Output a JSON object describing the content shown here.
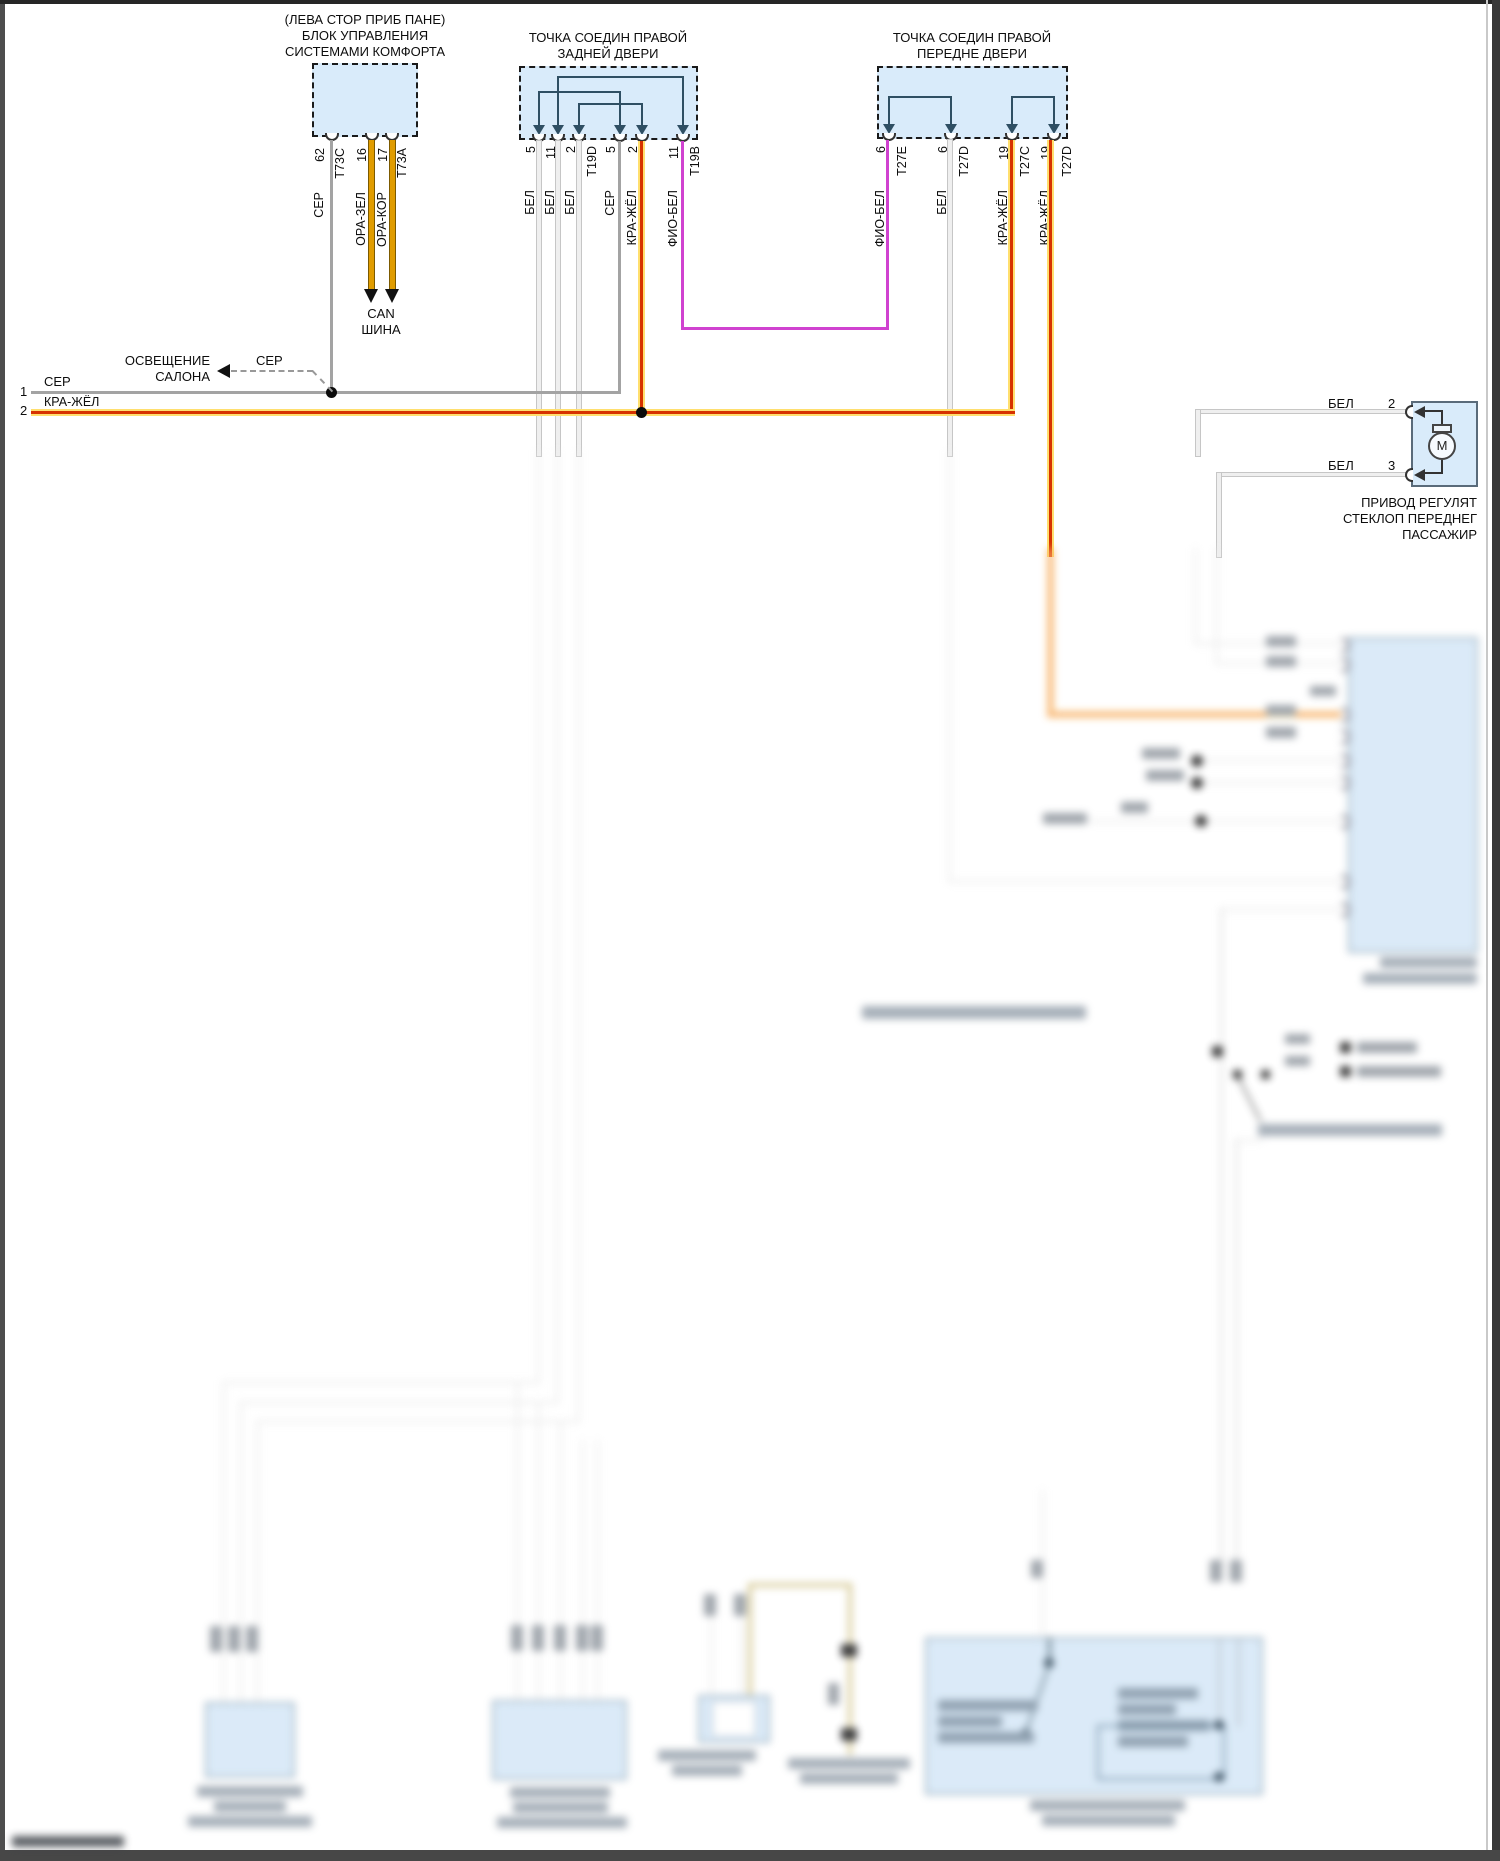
{
  "palette": {
    "canvas": "#ffffff",
    "box_fill": "#d9ebfa",
    "bridge": "#2f4f63",
    "wire_white": "#efefef",
    "wire_gray": "#a3a3a3",
    "wire_orange": "#e09c00",
    "wire_red_core": "#d63200",
    "wire_red_halo": "#ffdf6e",
    "wire_violet": "#d042d0",
    "blur_box_fill": "#d5e7f7"
  },
  "comfort_module": {
    "title1": "(ЛЕВА СТОР ПРИБ ПАНЕ)",
    "title2": "БЛОК УПРАВЛЕНИЯ",
    "title3": "СИСТЕМАМИ КОМФОРТА",
    "pin62": "62",
    "t73c": "T73C",
    "pin16": "16",
    "pin17": "17",
    "t73a": "T73A",
    "wire_ser": "СЕР",
    "wire_orazel": "ОРА-ЗЕЛ",
    "wire_orakor": "ОРА-КОР",
    "can1": "CAN",
    "can2": "ШИНА"
  },
  "rear_junction": {
    "title1": "ТОЧКА СОЕДИН ПРАВОЙ",
    "title2": "ЗАДНЕЙ ДВЕРИ",
    "pins": [
      "5",
      "11",
      "2",
      "T19D",
      "5",
      "2",
      "11",
      "T19B"
    ],
    "wires": [
      "БЕЛ",
      "БЕЛ",
      "БЕЛ",
      "СЕР",
      "КРА-ЖЁЛ",
      "ФИО-БЕЛ"
    ]
  },
  "front_junction": {
    "title1": "ТОЧКА СОЕДИН ПРАВОЙ",
    "title2": "ПЕРЕДНЕ ДВЕРИ",
    "pins": [
      "6",
      "T27E",
      "6",
      "T27D",
      "19",
      "T27C",
      "19",
      "T27D"
    ],
    "wires": [
      "ФИО-БЕЛ",
      "БЕЛ",
      "КРА-ЖЁЛ",
      "КРА-ЖЁЛ"
    ]
  },
  "bus": {
    "line1_num": "1",
    "line1_wire": "СЕР",
    "line2_num": "2",
    "line2_wire": "КРА-ЖЁЛ",
    "branch_wire": "СЕР",
    "branch_target1": "ОСВЕЩЕНИЕ",
    "branch_target2": "САЛОНА"
  },
  "motor": {
    "pin2_wire": "БЕЛ",
    "pin2": "2",
    "pin3_wire": "БЕЛ",
    "pin3": "3",
    "symbol": "M",
    "caption1": "ПРИВОД РЕГУЛЯТ",
    "caption2": "СТЕКЛОП ПЕРЕДНЕГ",
    "caption3": "ПАССАЖИР"
  }
}
